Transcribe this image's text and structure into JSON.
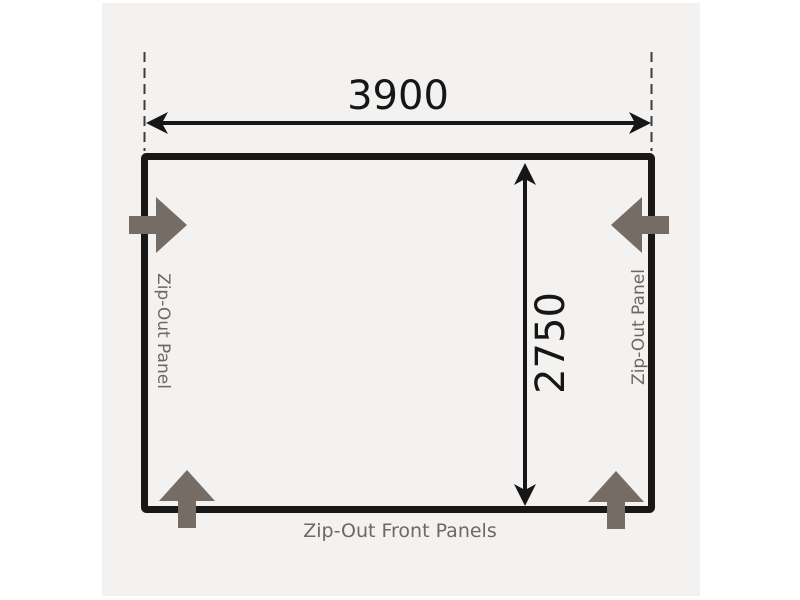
{
  "diagram": {
    "width_dimension": "3900",
    "depth_dimension": "2750",
    "left_panel_label": "Zip-Out Panel",
    "right_panel_label": "Zip-Out Panel",
    "front_panel_label": "Zip-Out Front Panels",
    "colors": {
      "canvas_background": "#f3f2f0",
      "outline_black": "#1a1816",
      "dimension_black": "#161616",
      "arrow_gray": "#756c66",
      "label_gray": "#6c6862",
      "dashed_gray": "#3c3c3c"
    }
  }
}
